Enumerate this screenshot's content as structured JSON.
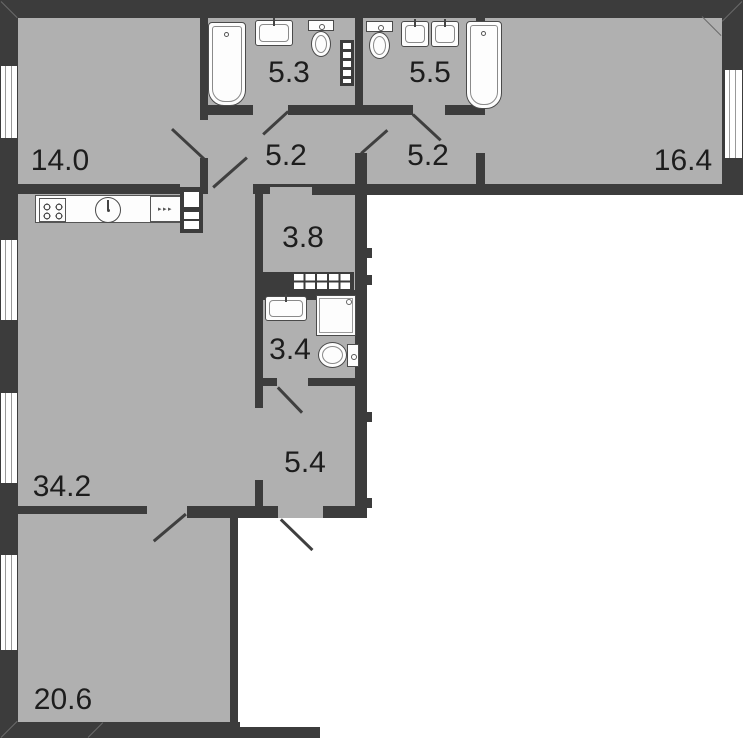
{
  "title": "Apartment floor plan",
  "rooms": [
    {
      "name": "room",
      "area": "14.0"
    },
    {
      "name": "bathroom",
      "area": "5.3"
    },
    {
      "name": "bathroom",
      "area": "5.5"
    },
    {
      "name": "corridor-left",
      "area": "5.2"
    },
    {
      "name": "corridor-right",
      "area": "5.2"
    },
    {
      "name": "room",
      "area": "16.4"
    },
    {
      "name": "hall",
      "area": "3.8"
    },
    {
      "name": "shower-room",
      "area": "3.4"
    },
    {
      "name": "entry-corridor",
      "area": "5.4"
    },
    {
      "name": "living-kitchen",
      "area": "34.2"
    },
    {
      "name": "room",
      "area": "20.6"
    }
  ],
  "fixtures": [
    "bathtub",
    "wash-sink",
    "toilet",
    "towel-radiator",
    "toilet",
    "wash-sink",
    "wash-sink",
    "bathtub",
    "stove",
    "kitchen-sink",
    "dishwasher",
    "fridge",
    "wardrobe",
    "wash-sink",
    "shower-tray",
    "toilet"
  ],
  "colors": {
    "wall": "#3c3c3c",
    "floor": "#b0b0b0",
    "outside": "#ffffff",
    "fixture_outline": "#4a4a4a",
    "label_text": "#1d1d1d"
  }
}
